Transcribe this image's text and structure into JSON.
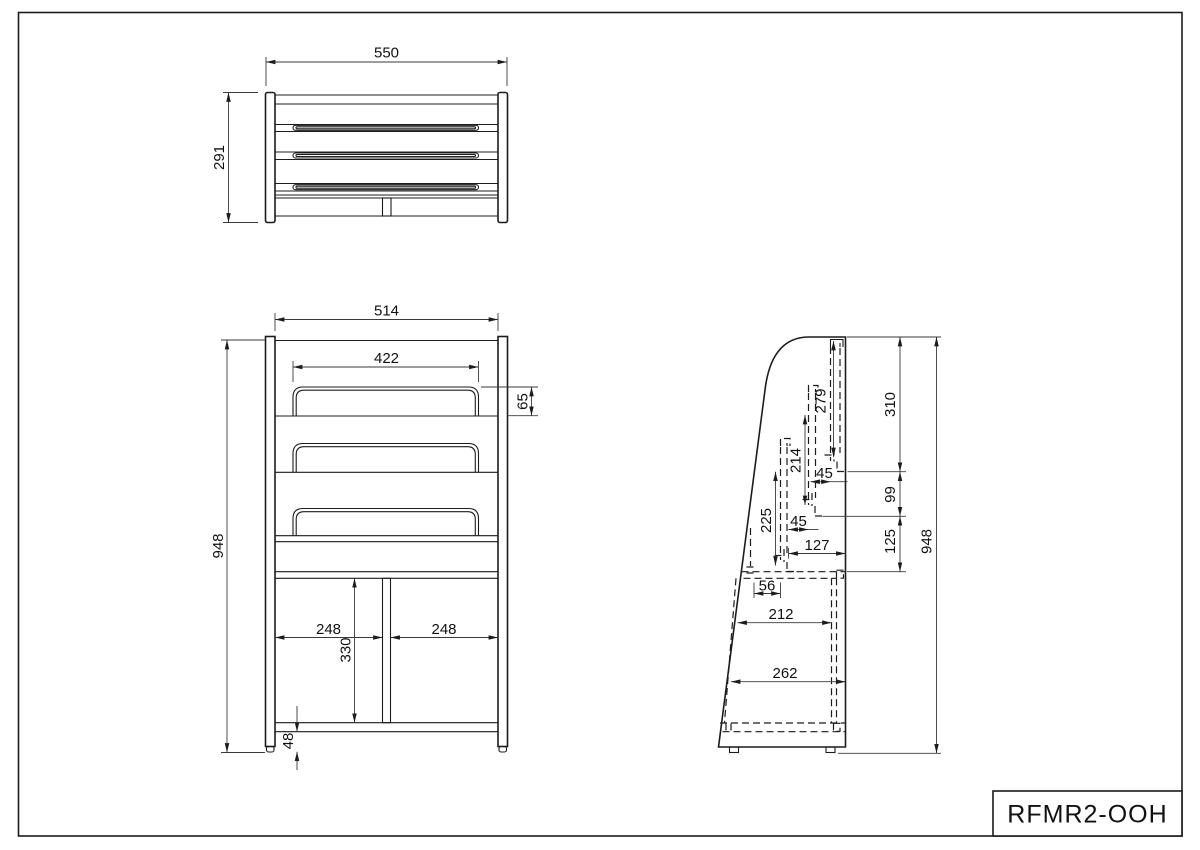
{
  "drawing": {
    "part_number": "RFMR2-OOH",
    "views": {
      "top": {
        "width": "550",
        "depth": "291"
      },
      "front": {
        "frame_width": "514",
        "pocket_width": "422",
        "pocket_lip_height": "65",
        "overall_height": "948",
        "shelf_span_left": "248",
        "shelf_span_right": "248",
        "compartment_height": "330",
        "base_clearance": "48"
      },
      "side": {
        "pocket_rear_depth": "279",
        "pocket_mid_depth": "214",
        "pocket_front_depth": "225",
        "pocket_stagger_upper": "45",
        "pocket_stagger_lower": "45",
        "segment_top": "310",
        "segment_mid": "99",
        "segment_lower": "125",
        "overall_height": "948",
        "rear_offset": "127",
        "front_offset": "56",
        "shelf_depth": "212",
        "base_depth": "262"
      }
    }
  }
}
